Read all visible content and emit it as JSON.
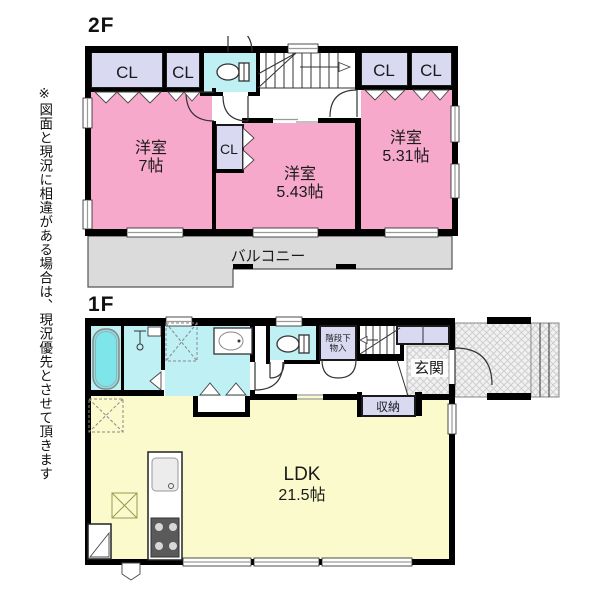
{
  "palette": {
    "pink": "#F7A9CB",
    "lavender": "#D9DAF2",
    "cyan": "#BFF0F4",
    "tub_cyan": "#7EE5EA",
    "yellow": "#FBFACD",
    "balcony_gray": "#DBDBDB",
    "wall": "#000000"
  },
  "disclaimer": "※図面と現況に相違がある場合は、現況優先とさせて頂きます",
  "floor2": {
    "label": "2F",
    "closet1": "CL",
    "closet2": "CL",
    "closet3": "CL",
    "closet4": "CL",
    "closet_mid": "CL",
    "bedroom_left_name": "洋室",
    "bedroom_left_size": "7帖",
    "bedroom_mid_name": "洋室",
    "bedroom_mid_size": "5.43帖",
    "bedroom_right_name": "洋室",
    "bedroom_right_size": "5.31帖",
    "balcony": "バルコニー"
  },
  "floor1": {
    "label": "1F",
    "under_stairs_storage_line1": "階段下",
    "under_stairs_storage_line2": "物入",
    "entrance": "玄関",
    "storage": "収納",
    "ldk_name": "LDK",
    "ldk_size": "21.5帖"
  }
}
